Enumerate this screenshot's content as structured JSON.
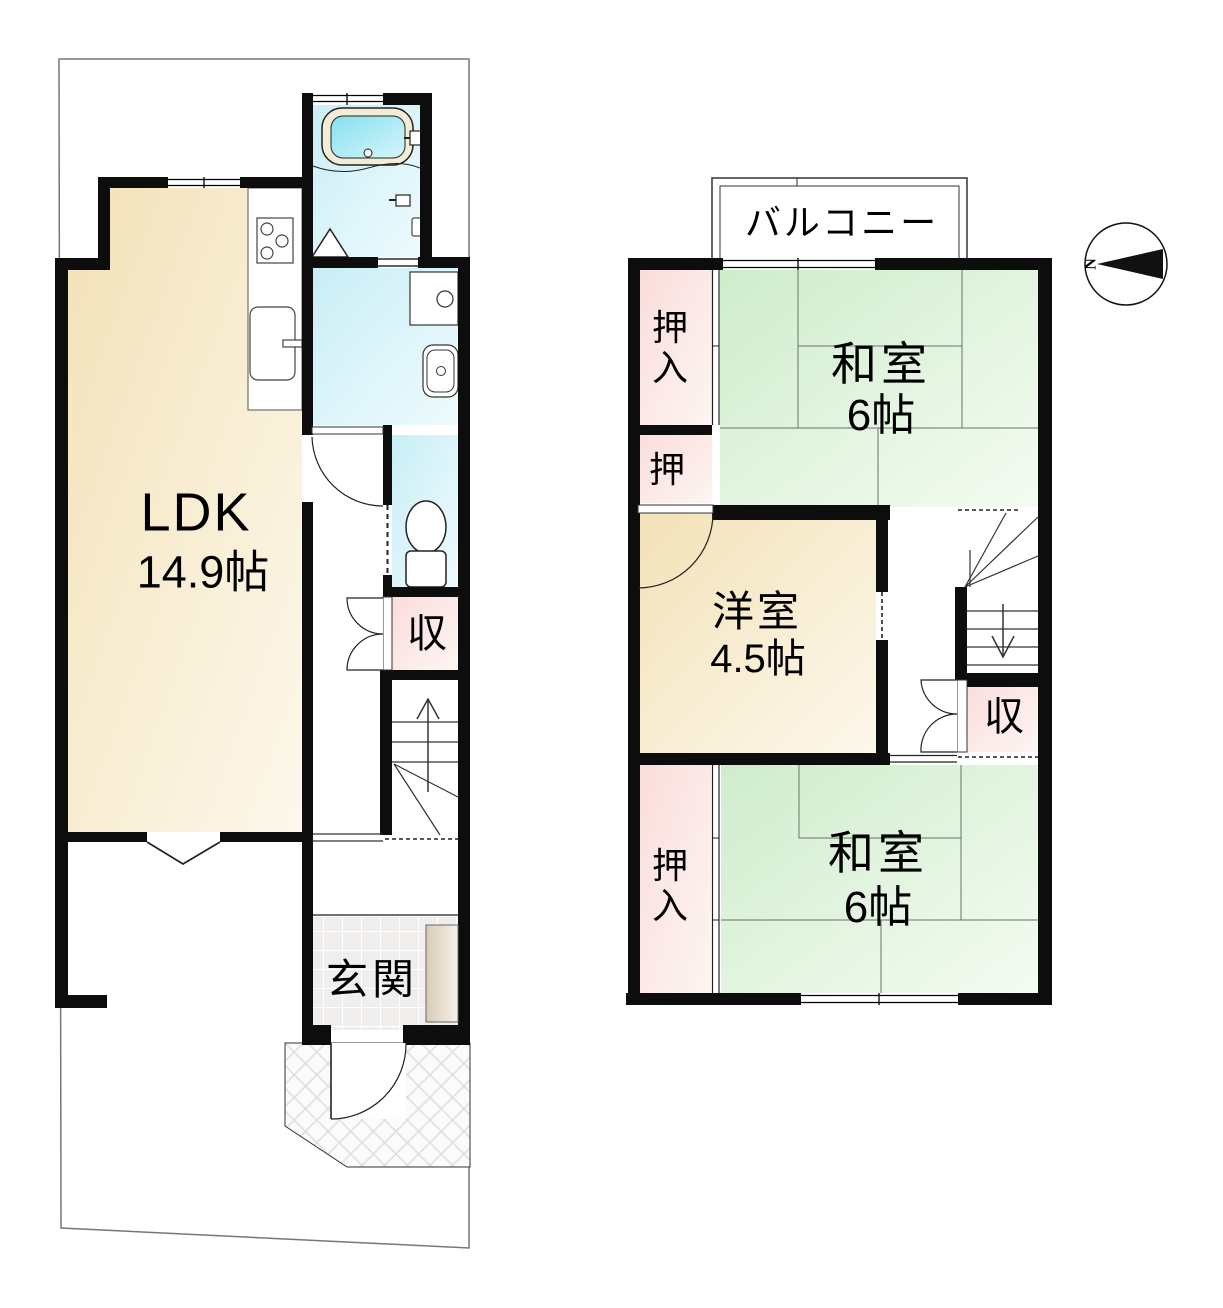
{
  "floor1": {
    "ldk_name": "LDK",
    "ldk_size": "14.9帖",
    "entrance": "玄関",
    "storage": "収"
  },
  "floor2": {
    "balcony": "バルコニー",
    "washitsu_north_name": "和室",
    "washitsu_north_size": "6帖",
    "youshitsu_name": "洋室",
    "youshitsu_size": "4.5帖",
    "washitsu_south_name": "和室",
    "washitsu_south_size": "6帖",
    "closet_north_char1": "押",
    "closet_north_char2": "入",
    "closet_mid": "押",
    "closet_south_char1": "押",
    "closet_south_char2": "入",
    "storage": "収"
  },
  "compass": {
    "north_label": "N"
  },
  "colors": {
    "wall": "#0d0d0d",
    "ldk_floor": "#f3e2b8",
    "tatami_floor": "#cfeccc",
    "closet_floor": "#fadddb",
    "wet_area_floor": "#c9eef6",
    "bath_water": "#86dff0",
    "cabinet": "#d8cab6",
    "site_line": "#777777"
  }
}
